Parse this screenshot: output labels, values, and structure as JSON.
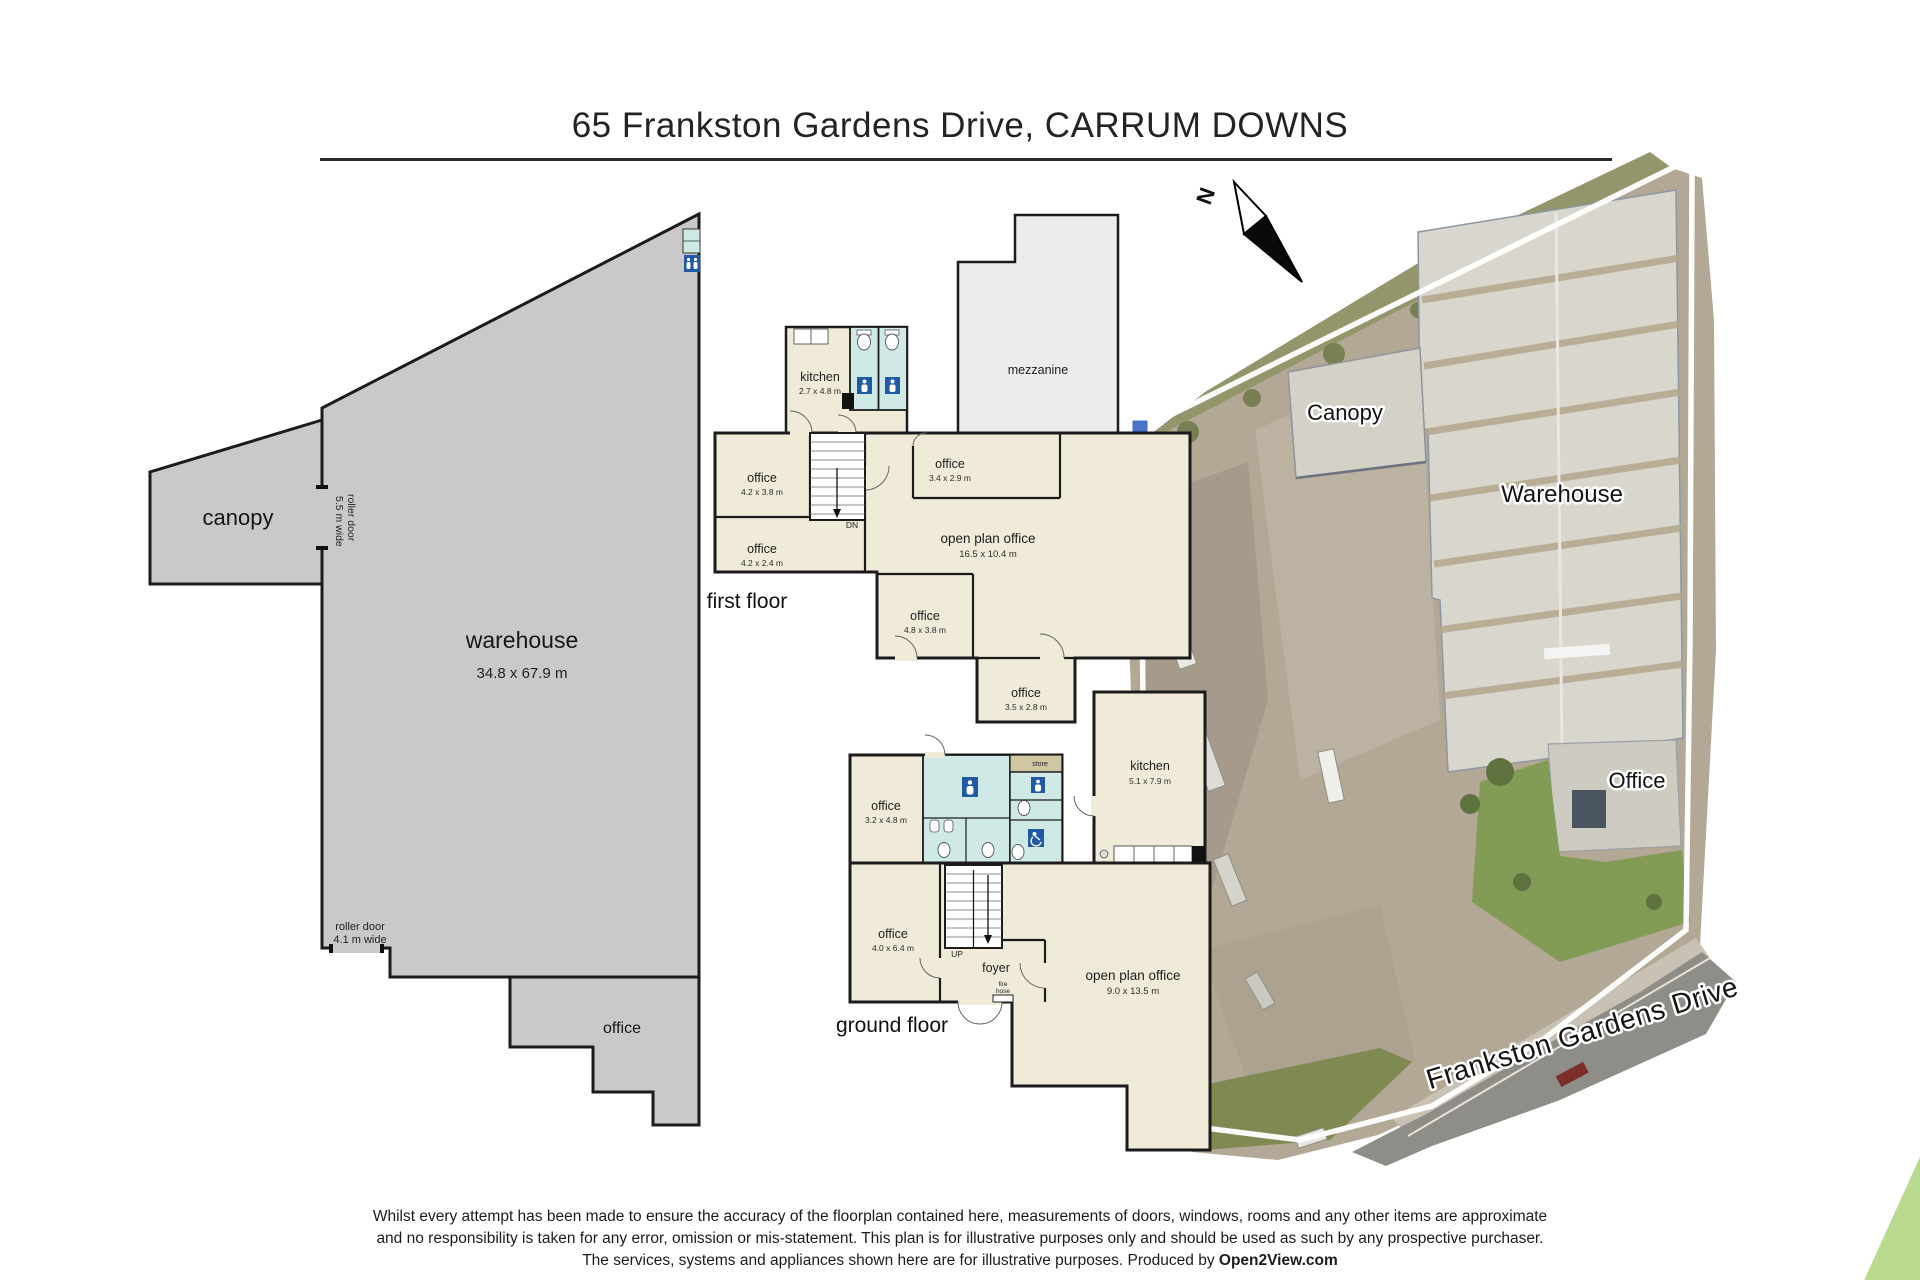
{
  "header": {
    "title": "65 Frankston Gardens Drive, CARRUM DOWNS"
  },
  "north": {
    "label": "N"
  },
  "warehouse_plan": {
    "canopy": "canopy",
    "name": "warehouse",
    "dims": "34.8 x 67.9 m",
    "roller_side_1": "roller door",
    "roller_side_2": "5.5 m wide",
    "roller_bottom_1": "roller door",
    "roller_bottom_2": "4.1 m wide",
    "office": "office"
  },
  "first_floor": {
    "label": "first floor",
    "mezzanine": "mezzanine",
    "dn": "DN",
    "rooms": [
      {
        "name": "kitchen",
        "dims": "2.7 x 4.8 m"
      },
      {
        "name": "office",
        "dims": "4.2 x 3.8 m"
      },
      {
        "name": "office",
        "dims": "4.2 x 2.4 m"
      },
      {
        "name": "office",
        "dims": "3.4 x 2.9 m"
      },
      {
        "name": "open plan office",
        "dims": "16.5 x 10.4 m"
      },
      {
        "name": "office",
        "dims": "4.8 x 3.8 m"
      },
      {
        "name": "office",
        "dims": "3.5 x 2.8 m"
      }
    ]
  },
  "ground_floor": {
    "label": "ground floor",
    "up": "UP",
    "foyer": "foyer",
    "store": "store",
    "fire_1": "fire",
    "fire_2": "hose",
    "rooms": [
      {
        "name": "office",
        "dims": "3.2 x 4.8 m"
      },
      {
        "name": "kitchen",
        "dims": "5.1 x 7.9 m"
      },
      {
        "name": "office",
        "dims": "4.0 x 6.4 m"
      },
      {
        "name": "open plan office",
        "dims": "9.0 x 13.5 m"
      }
    ]
  },
  "aerial": {
    "canopy": "Canopy",
    "warehouse": "Warehouse",
    "office": "Office",
    "street": "Frankston Gardens Drive"
  },
  "footer": {
    "line1": "Whilst every attempt has been made to ensure the accuracy of the floorplan contained here, measurements of doors, windows, rooms and any other items are approximate",
    "line2": "and no responsibility is taken for any error, omission or mis-statement.  This plan is for illustrative purposes only and should be used as such by any prospective purchaser.",
    "line3": "The services, systems and appliances shown here are for illustrative purposes.   Produced by ",
    "brand": "Open2View.com"
  },
  "colors": {
    "plan_beige": "#f0ead9",
    "plan_teal": "#cfe9e7",
    "warehouse_gray": "#c9c9c9",
    "mezzanine_gray": "#ececec",
    "sign_blue": "#2159a5",
    "store_khaki": "#cfc6a2",
    "corner_green": "#b9d98e",
    "concrete": "#b3a896",
    "roof_gray": "#d9d6cd",
    "roof_stripe": "#b5a68c",
    "grass_green": "#7c9a4e"
  }
}
